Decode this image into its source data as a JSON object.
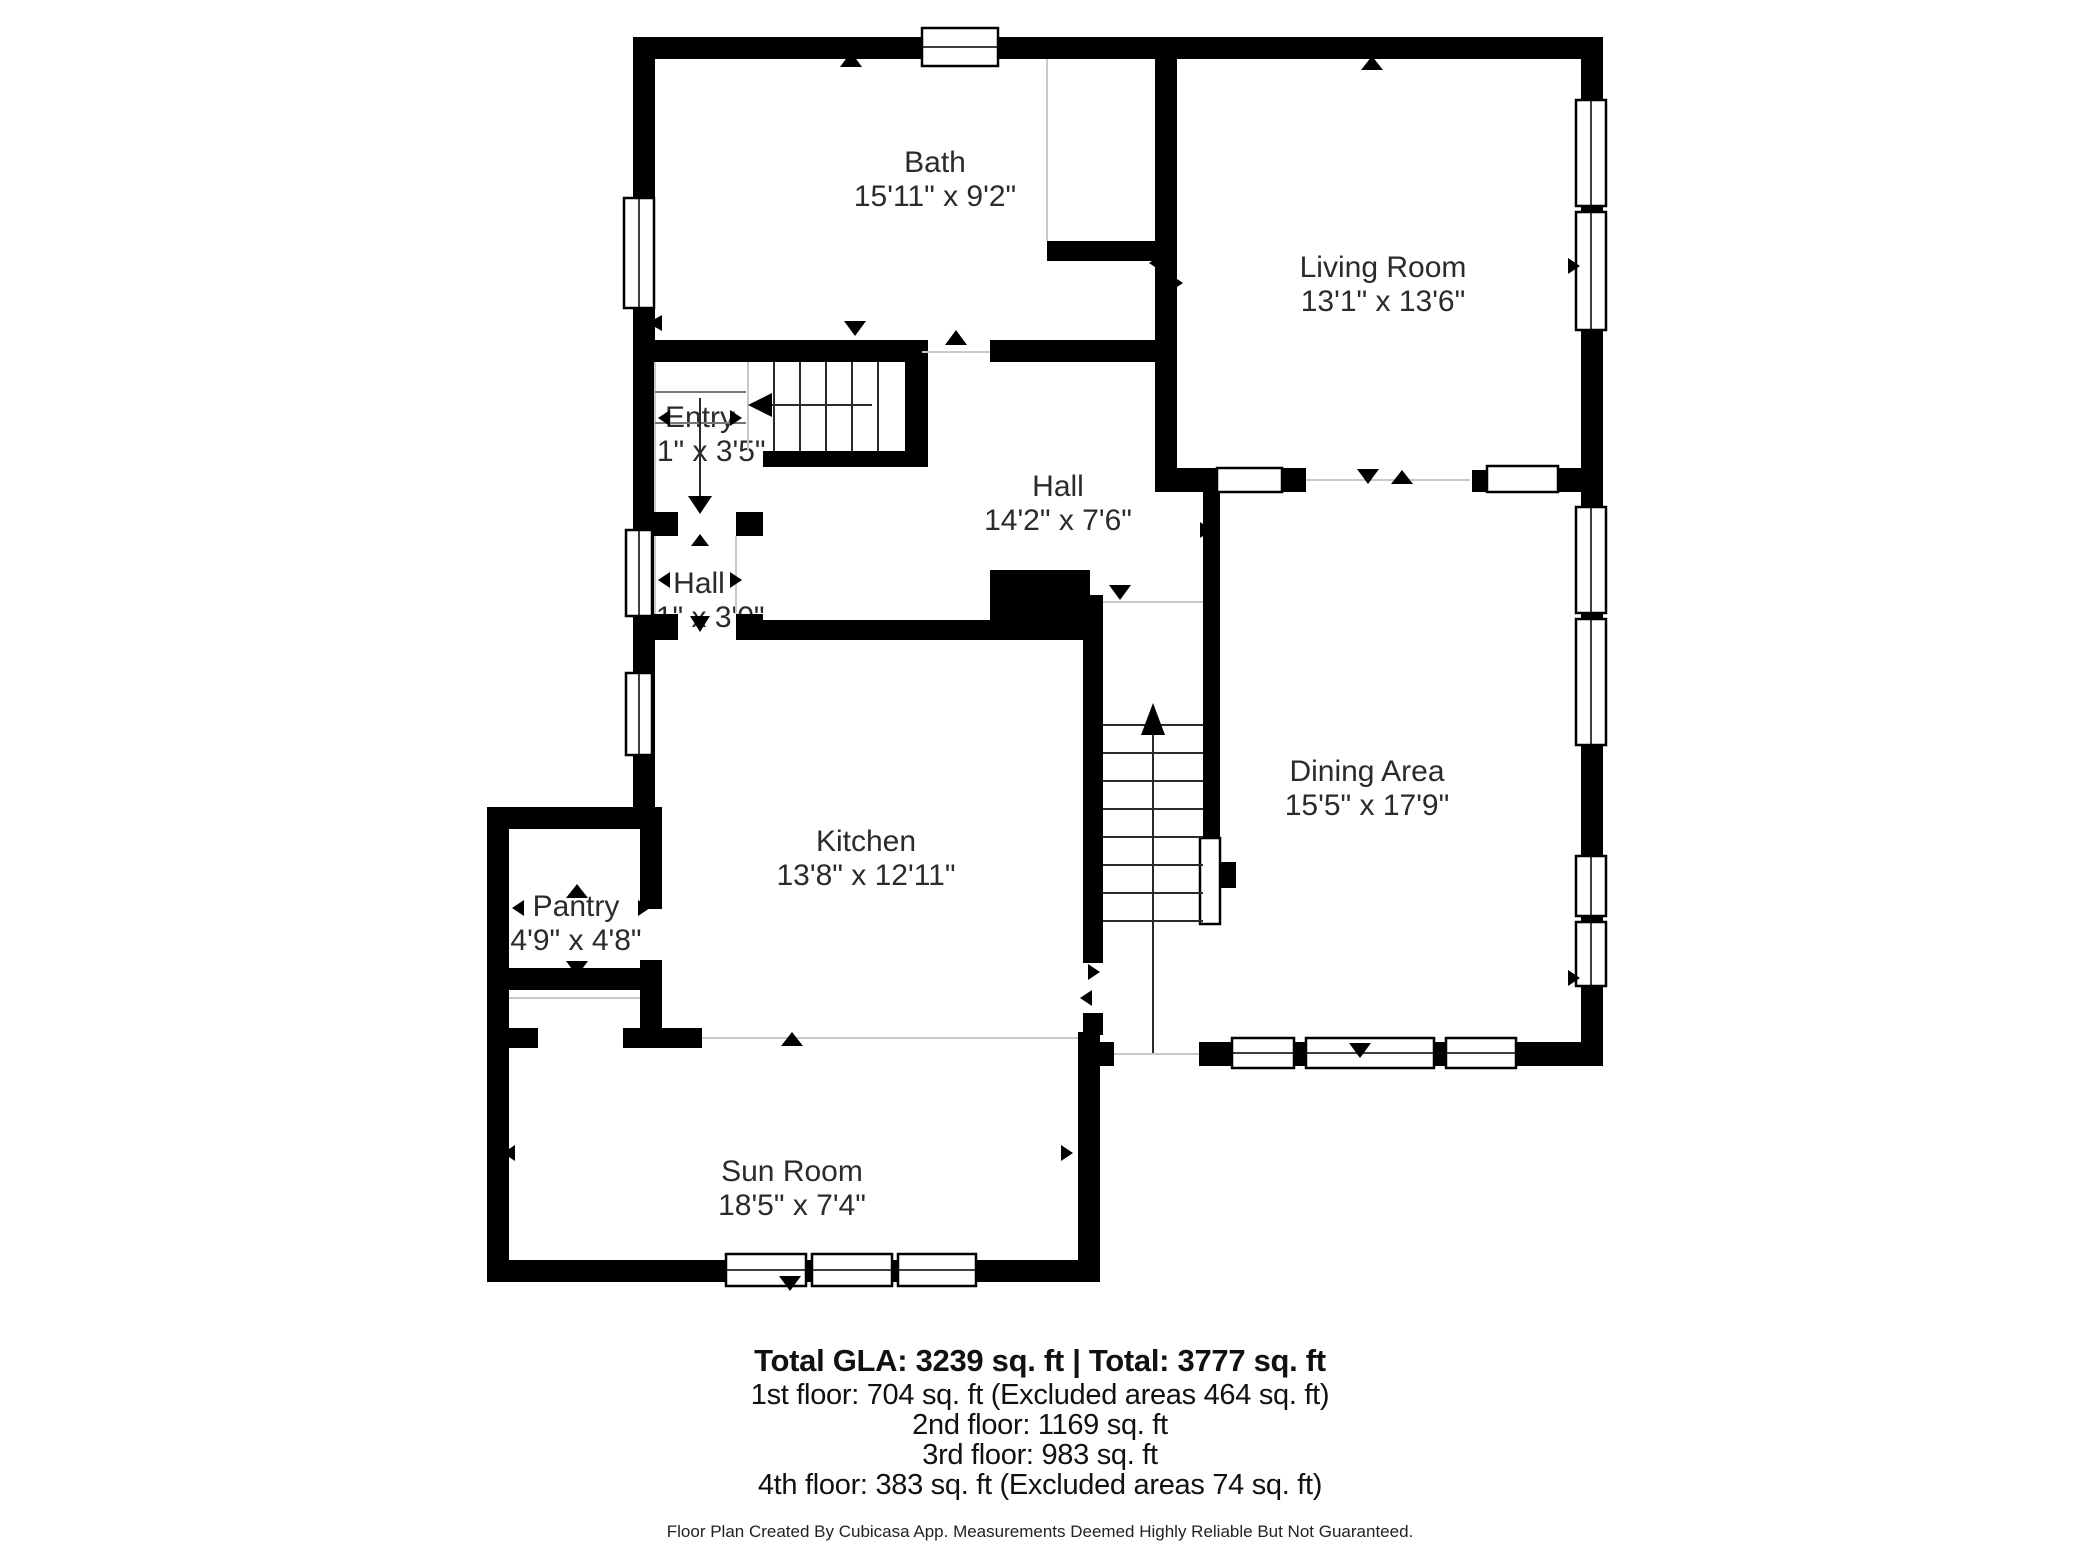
{
  "plan": {
    "colors": {
      "wall": "#000000",
      "background": "#ffffff",
      "text": "#2b2b2b"
    },
    "rooms": [
      {
        "name": "Bath",
        "dims": "15'11\" x 9'2\""
      },
      {
        "name": "Living Room",
        "dims": "13'1\" x 13'6\""
      },
      {
        "name": "Entry",
        "dims": "3'1\" x 3'5\""
      },
      {
        "name": "Hall",
        "dims": "14'2\" x 7'6\""
      },
      {
        "name": "Hall",
        "dims": "3'1\" x 3'0\""
      },
      {
        "name": "Kitchen",
        "dims": "13'8\" x 12'11\""
      },
      {
        "name": "Pantry",
        "dims": "4'9\" x 4'8\""
      },
      {
        "name": "Dining Area",
        "dims": "15'5\" x 17'9\""
      },
      {
        "name": "Sun Room",
        "dims": "18'5\" x 7'4\""
      }
    ]
  },
  "summary": {
    "total_line": "Total GLA: 3239 sq. ft | Total: 3777 sq. ft",
    "floors": [
      "1st floor: 704 sq. ft (Excluded areas 464 sq. ft)",
      "2nd floor: 1169 sq. ft",
      "3rd floor: 983 sq. ft",
      "4th floor: 383 sq. ft (Excluded areas 74 sq. ft)"
    ],
    "disclaimer": "Floor Plan Created By Cubicasa App. Measurements Deemed Highly Reliable But Not Guaranteed."
  }
}
